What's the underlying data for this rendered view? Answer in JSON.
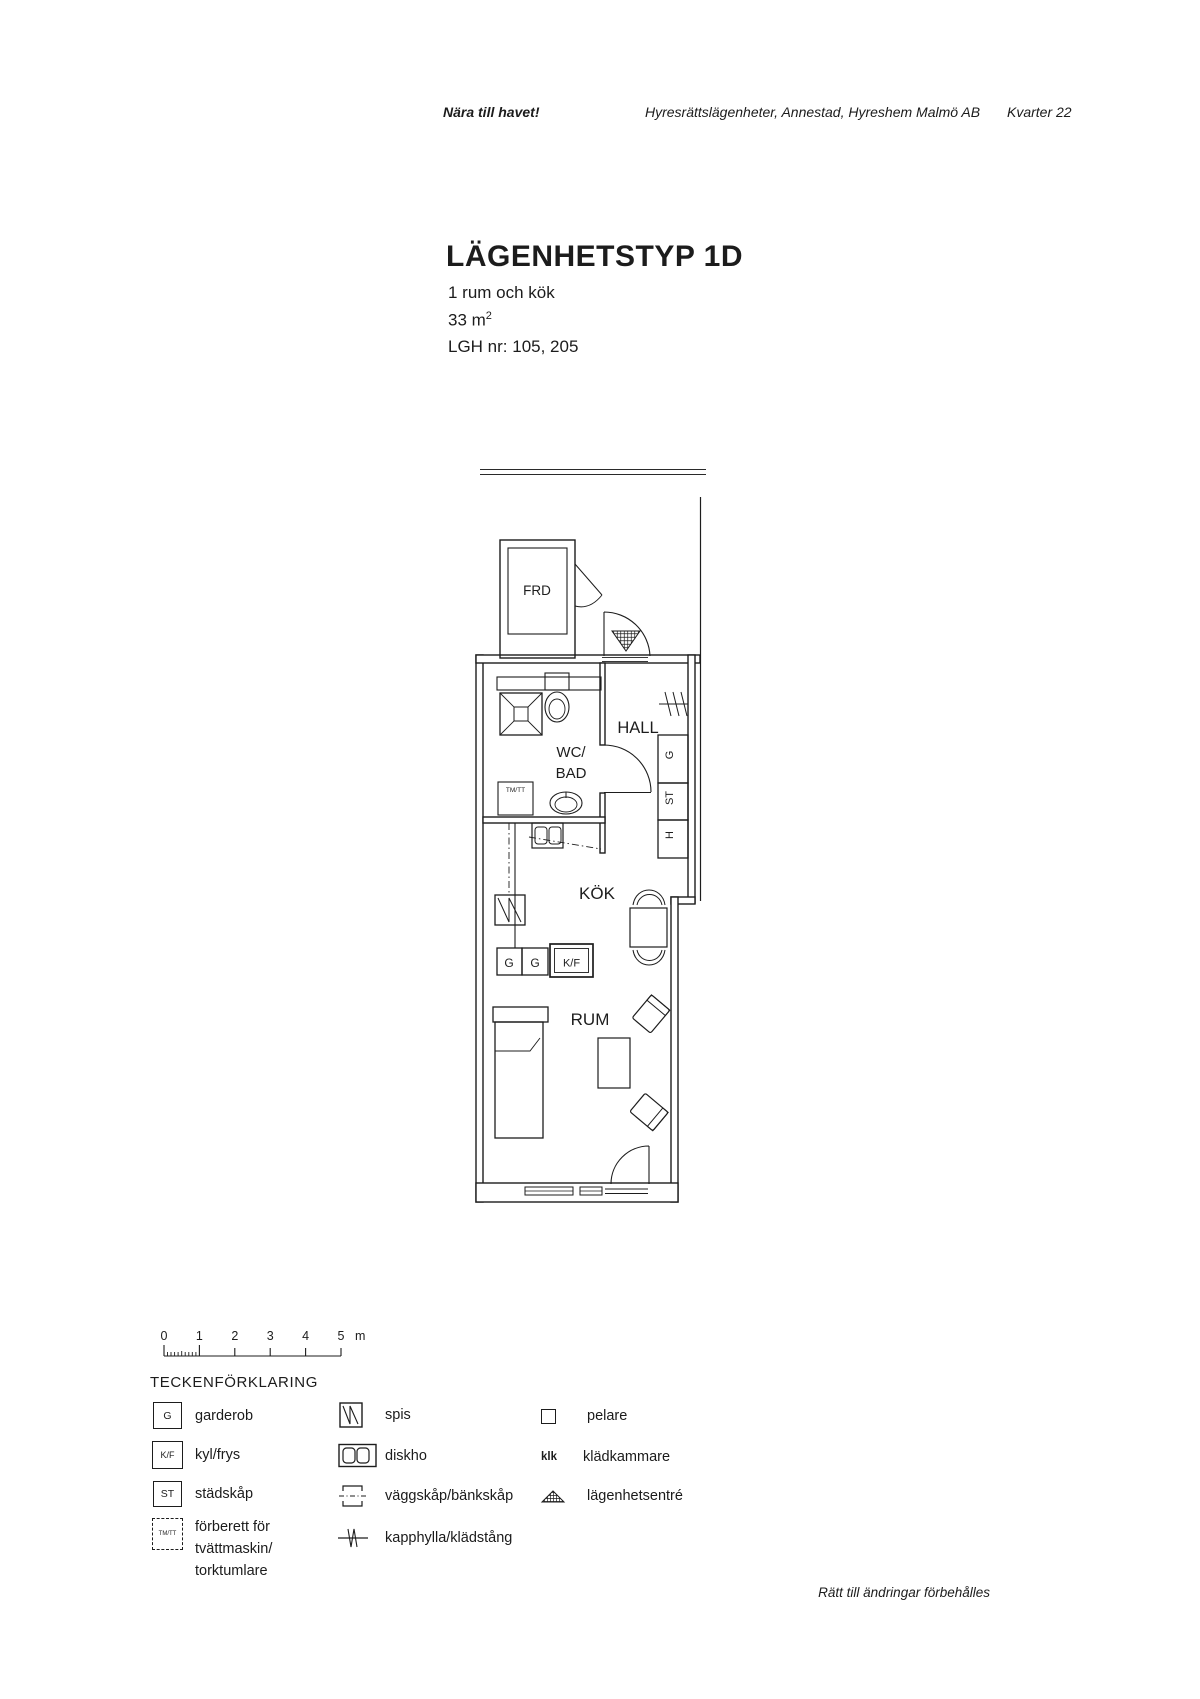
{
  "header": {
    "tagline": "Nära till havet!",
    "subtitle": "Hyresrättslägenheter, Annestad, Hyreshem Malmö AB",
    "block": "Kvarter 22"
  },
  "title": {
    "heading": "LÄGENHETSTYP 1D",
    "rooms": "1 rum och kök",
    "area": "33 m",
    "area_sup": "2",
    "lgh": "LGH nr: 105, 205"
  },
  "plan": {
    "labels": {
      "frd": "FRD",
      "hall": "HALL",
      "wc": "WC/",
      "bad": "BAD",
      "tmtt": "TM/TT",
      "kok": "KÖK",
      "kf": "K/F",
      "g": "G",
      "rum": "RUM",
      "closet_g": "G",
      "closet_st": "ST",
      "closet_h": "H"
    }
  },
  "scale": {
    "ticks": [
      "0",
      "1",
      "2",
      "3",
      "4",
      "5"
    ],
    "unit": "m"
  },
  "legend": {
    "title": "TECKENFÖRKLARING",
    "items": [
      {
        "symbol": "G",
        "label": "garderob"
      },
      {
        "symbol": "K/F",
        "label": "kyl/frys"
      },
      {
        "symbol": "ST",
        "label": "städskåp"
      },
      {
        "symbol": "TM/TT",
        "label": "förberett för",
        "label2": "tvättmaskin/",
        "label3": "torktumlare"
      },
      {
        "label": "spis"
      },
      {
        "label": "diskho"
      },
      {
        "label": "väggskåp/bänkskåp"
      },
      {
        "label": "kapphylla/klädstång"
      },
      {
        "label": "pelare"
      },
      {
        "symbol": "klk",
        "label": "klädkammare"
      },
      {
        "label": "lägenhetsentré"
      }
    ]
  },
  "footer": {
    "note": "Rätt till ändringar förbehålles"
  }
}
